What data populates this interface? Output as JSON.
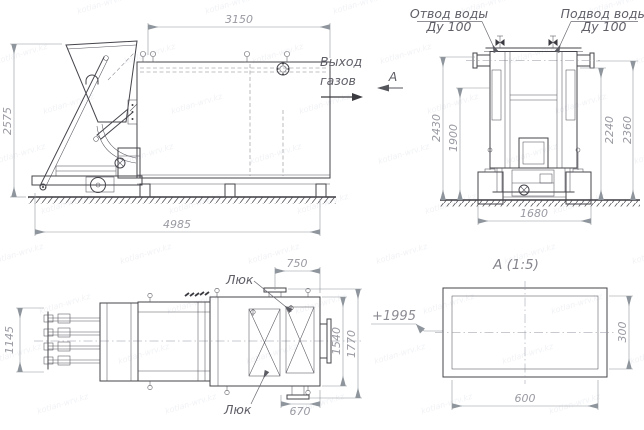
{
  "watermark": {
    "text": "kotlan-wrv.kz"
  },
  "colors": {
    "line": "#44444b",
    "dimension": "#8f959c",
    "label": "#5f5f68",
    "accent": "#3a3a40"
  },
  "side_view": {
    "dim_width_top": "3150",
    "dim_height": "2575",
    "dim_length": "4985",
    "gas_outlet_line1": "Выход",
    "gas_outlet_line2": "газов",
    "view_label": "А"
  },
  "end_view": {
    "outlet_line1": "Отвод воды",
    "outlet_line2": "Ду 100",
    "inlet_line1": "Подвод воды",
    "inlet_line2": "Ду 100",
    "dim_h_outer_left": "2430",
    "dim_h_inner_left": "1900",
    "dim_h_inner_right": "2240",
    "dim_h_outer_right": "2360",
    "dim_base": "1680"
  },
  "plan_view": {
    "dim_feeder": "1145",
    "dim_top": "750",
    "dim_bottom": "670",
    "dim_inner": "1540",
    "dim_outer": "1770",
    "hatch_label_top": "Люк",
    "hatch_label_bottom": "Люк",
    "elevation_mark": "+1995"
  },
  "detail_view": {
    "title": "А (1:5)",
    "dim_width": "600",
    "dim_height": "300"
  }
}
